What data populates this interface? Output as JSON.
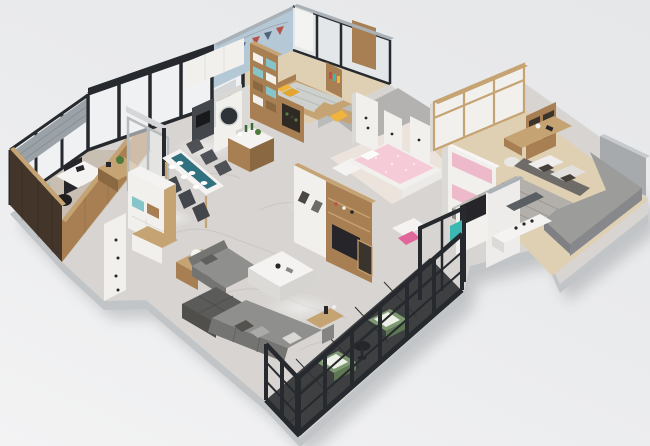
{
  "scene": {
    "subject": "apartment-floor-plan-3d-render",
    "view": "isometric-cutaway-dollhouse",
    "description": "Photorealistic 3D isometric cutaway render of a furnished apartment floor plan on a plain light gray background",
    "background": {
      "bg_top": "#e6e7e9",
      "bg_mid": "#eaebed",
      "bg_bottom": "#f3f3f4"
    },
    "palette": {
      "bg_top": "#e6e7e9",
      "bg_mid": "#eaebed",
      "bg_bottom": "#f3f3f4",
      "plinth": "#c1c5c7",
      "shadow": "#3a3f45",
      "marble": "#d7d4d1",
      "marble_vein": "#c2bebb",
      "concrete": "#b3b2b0",
      "study_floor": "#c8bfb2",
      "wood": "#a87f52",
      "wood_light": "#c6a372",
      "wood_dark": "#8a6842",
      "wood_deep": "#43352a",
      "white_furn": "#f1f0ed",
      "white_side": "#dcdad6",
      "white_top": "#f4f3f1",
      "gray_panel": "#d4d6d7",
      "wall_white": "#edecea",
      "wall_cap": "#a9b1b7",
      "blue_wall": "#b5c8d6",
      "window_pale": "#e3e7e9",
      "glass": "#eff1f2",
      "frame_black": "#26292d",
      "frame_gray": "#b7bbbd",
      "curtain": "#9aa1a7",
      "teal": "#85c4c8",
      "teal_dark": "#31707f",
      "teal_bright": "#3cb8b2",
      "yellow": "#f0b43c",
      "yellow_dark": "#e3a52f",
      "pink": "#f5cbd8",
      "pink_panel": "#eeb9ca",
      "pink_bright": "#e0679b",
      "pink_floor": "#ece4dc",
      "sofa": "#8f8f8d",
      "sofa_dark": "#747472",
      "sofa_deep": "#5b5b59",
      "cushion_light": "#aaaaa8",
      "cushion_white": "#d9d8d5",
      "bed_gray": "#b3b0ac",
      "bed_light": "#c8c5c1",
      "bed_side": "#908d89",
      "headboard": "#6e6b68",
      "green": "#7e9871",
      "green_dark": "#5e7854",
      "cushion_green_white": "#edf0e7",
      "dark_tile": "#3d3f41",
      "tile_line": "#2f3133",
      "wood_floor": "#dfd0b4",
      "rug": "#8e8b88",
      "dark_item": "#26262a",
      "lamp_white": "#f6f4ef",
      "gray_wall": "#a6aaac",
      "gray_platform": "#b6babc",
      "gray_fabric": "#9c9c9a",
      "gray_fabric_dark": "#86888b",
      "plant_green": "#4e7a3a"
    },
    "rooms": [
      {
        "name": "study",
        "key_items": [
          "desk",
          "office-chair",
          "mint-accent-panel",
          "bar-table",
          "plant",
          "dark-wood-feature-wall",
          "window-blinds"
        ]
      },
      {
        "name": "kids-bedroom-blue",
        "key_items": [
          "bed-with-yellow-pillows",
          "bunting-garland",
          "cubby-bookshelf-teal-backs",
          "desk",
          "yellow-chair",
          "tv-dresser",
          "black-framed-window",
          "wood-door"
        ]
      },
      {
        "name": "kitchen",
        "key_items": [
          "island-counter",
          "washing-machine",
          "dark-cooktop-unit",
          "white-upper-cabinets",
          "wine-cabinet"
        ]
      },
      {
        "name": "dining-area",
        "key_items": [
          "white-dining-table",
          "teal-table-runner",
          "six-dark-chairs",
          "place-settings"
        ]
      },
      {
        "name": "entry",
        "key_items": [
          "white-sideboard-with-teal-cubbies",
          "shoe-bench",
          "white-door-panel"
        ]
      },
      {
        "name": "hallway",
        "key_items": [
          "white-door-panels",
          "concrete-floor"
        ]
      },
      {
        "name": "living-room",
        "key_items": [
          "l-shaped-gray-sofa",
          "tufted-ottoman",
          "white-marble-coffee-table",
          "side-table-with-ball-lamp",
          "wood-console",
          "tv-media-wall"
        ]
      },
      {
        "name": "kids-bedroom-pink",
        "key_items": [
          "pink-bed",
          "pink-white-wardrobe",
          "vanity-desk",
          "floor-lamp",
          "pink-chair",
          "teal-cart"
        ]
      },
      {
        "name": "master-bedroom",
        "key_items": [
          "double-bed-striped-gray-duvet",
          "white-and-dark-pillows",
          "gray-upholstered-surround",
          "wardrobe-wall",
          "corner-shelf",
          "desk",
          "pouf",
          "rug",
          "wall-tv",
          "white-partition"
        ]
      },
      {
        "name": "bathroom",
        "key_items": [
          "vanity-counter",
          "mirror",
          "toiletries"
        ]
      },
      {
        "name": "balcony",
        "key_items": [
          "black-metal-railing",
          "two-green-armchairs",
          "round-side-table",
          "dark-tile-floor",
          "black-glass-door-frame"
        ]
      }
    ],
    "structures": [
      "black-framed-glass-partition",
      "gray-sliding-doors",
      "white-partition-walls",
      "gray-base-plinth",
      "soft-drop-shadow"
    ]
  }
}
